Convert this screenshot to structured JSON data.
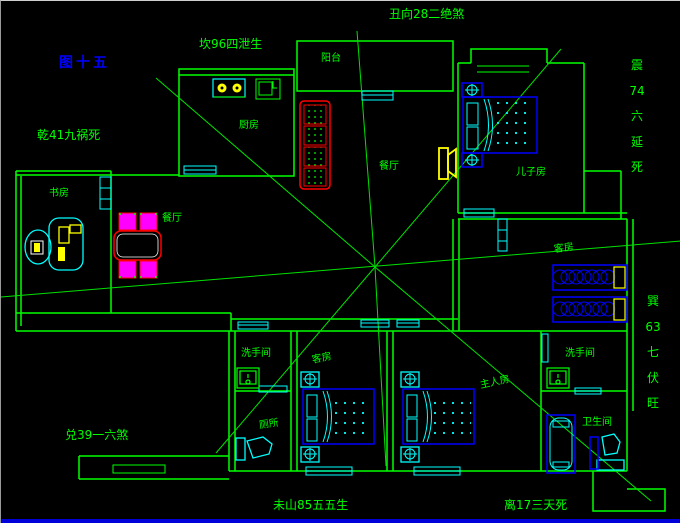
{
  "canvas": {
    "width": 680,
    "height": 522,
    "background": "#000000"
  },
  "palette": {
    "wall": "#00ff00",
    "window_door": "#00ffff",
    "bed": "#0000ff",
    "sofa_table": "#ff0000",
    "chair_fill": "#ff00ff",
    "appliance": "#ffff00",
    "figure_label": "#0000ff",
    "statusbar": "#0000d8"
  },
  "annotations": {
    "figure_no": "图十五",
    "top_center": "丑向28二绝煞",
    "top_left": "坎96四泄生",
    "left_upper": "乾41九祸死",
    "left_lower": "兑39一六煞",
    "bottom_center": "未山85五五生",
    "bottom_right": "离17三天死",
    "right_upper_vertical": [
      "震",
      "74",
      "六",
      "延",
      "死"
    ],
    "right_lower_vertical": [
      "巽",
      "63",
      "七",
      "伏",
      "旺"
    ]
  },
  "rooms": {
    "kitchen": "厨房",
    "balcony": "阳台",
    "study": "书房",
    "dining": "餐厅",
    "living": "餐厅",
    "son_room": "儿子房",
    "guest_room_right": "客房",
    "washroom_left": "洗手间",
    "toilet_room": "厕所",
    "guest_room_bottom": "客房",
    "master_room": "主人房",
    "washroom_right": "洗手间",
    "bathroom": "卫生间"
  }
}
